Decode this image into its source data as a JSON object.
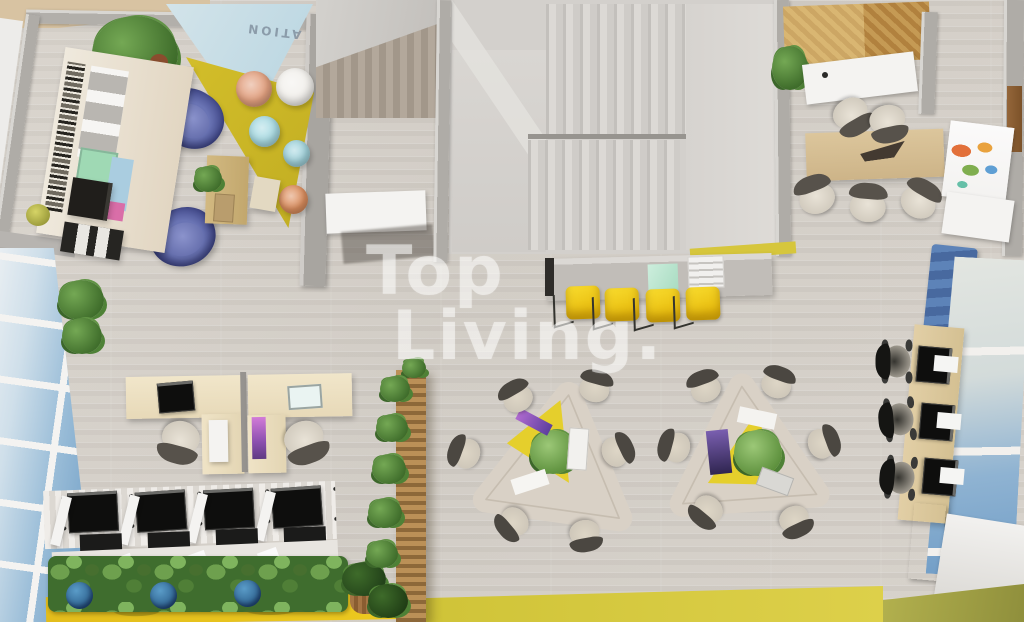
{
  "watermark": {
    "line1": "Top",
    "line2": "Living."
  },
  "floor_decal": {
    "text": "ATION"
  },
  "palette": {
    "floor_wood": "#d7d2cb",
    "wall_gray": "#b2afaa",
    "accent_yellow": "#e0c92c",
    "bar_chair_yellow": "#f2cc16",
    "armchair_blue": "#3d4486",
    "pouf_salmon": "#e2a07f",
    "pouf_light_blue": "#a9dbe3",
    "planter_pot_blue": "#2e6fa3",
    "sea_view_blue": "#7fa9cf",
    "partition_wood": "#a5794a",
    "desk_birch": "#eee2c5",
    "meeting_table_oak": "#d7c096",
    "watermark_white": "#ffffff"
  },
  "inventory": {
    "lounge_poufs": 5,
    "blue_armchairs": 2,
    "yellow_bar_chairs": 4,
    "meeting_room_chairs": 5,
    "collaboration_tables": 2,
    "collaboration_chairs": 12,
    "carrel_workstations": 4,
    "window_desk_laptops": 3,
    "window_desk_chairs": 3,
    "l_shaped_desks": 2,
    "staircase_flights": 2
  }
}
